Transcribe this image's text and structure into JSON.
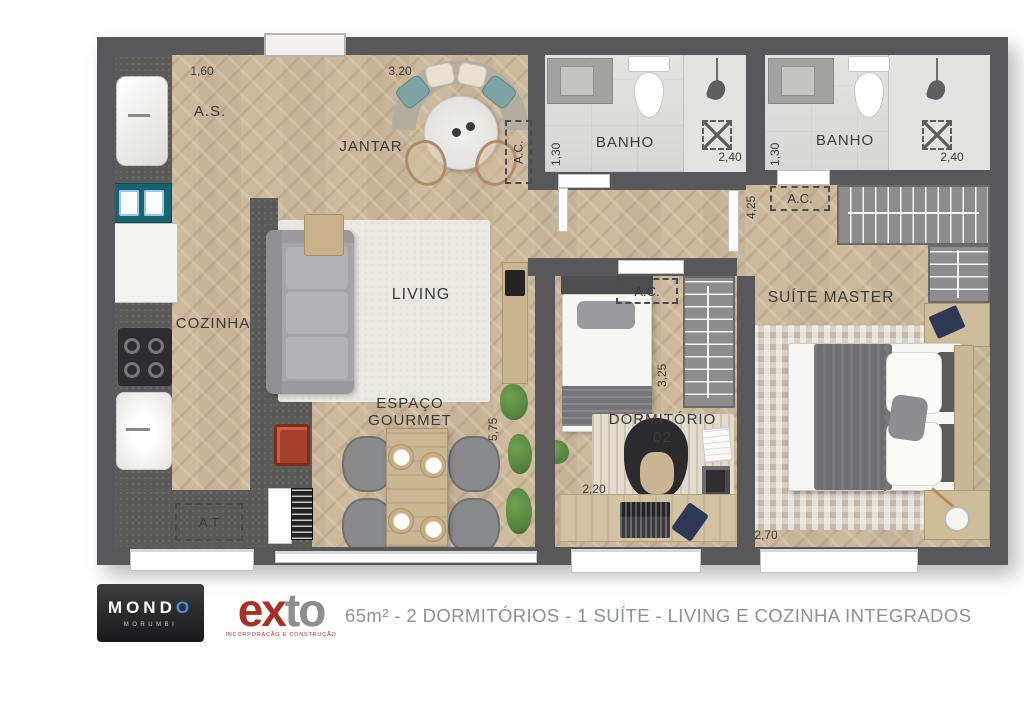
{
  "colors": {
    "wall": "#58585a",
    "wood": "#cdb99c",
    "granite": "#5a5a58",
    "bath": "#dadad8",
    "teal": "#156570",
    "red": "#a63125",
    "blue": "#4a90d9",
    "cap": "#8e9195",
    "green": "#56813f",
    "ink": "#3b3b39"
  },
  "plan": {
    "rooms": {
      "as": "A.S.",
      "jantar": "JANTAR",
      "cozinha": "COZINHA",
      "living": "LIVING",
      "gourmet_line1": "ESPAÇO",
      "gourmet_line2": "GOURMET",
      "banho": "BANHO",
      "dormitorio_line1": "DORMITÓRIO",
      "dormitorio_line2": "02",
      "suite": "SUÍTE MASTER"
    },
    "zones": {
      "ac": "A.C.",
      "at": "A.T"
    },
    "dims": {
      "as_width": "1,60",
      "jantar_width": "3,20",
      "banho_depth": "1,30",
      "banho_width": "2,40",
      "suite_hall": "4,25",
      "dorm_depth": "3,25",
      "gourmet_length": "5,75",
      "dorm_width": "2,20",
      "suite_width": "2,70"
    }
  },
  "footer": {
    "mondo": {
      "name_main": "MOND",
      "name_o": "O",
      "subtitle": "MORUMBI"
    },
    "exto": {
      "name_left": "ex",
      "name_right": "to",
      "subtitle": "INCORPORAÇÃO E CONSTRUÇÃO"
    },
    "caption": "65m² - 2 DORMITÓRIOS - 1 SUÍTE - LIVING E COZINHA INTEGRADOS"
  }
}
